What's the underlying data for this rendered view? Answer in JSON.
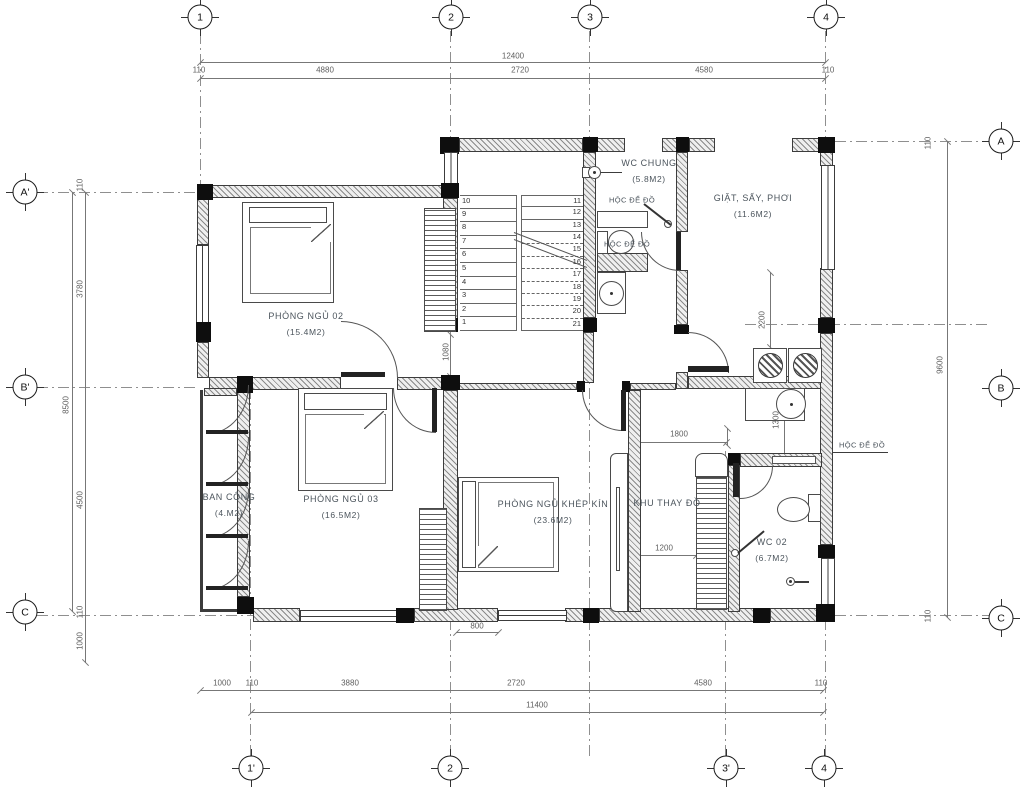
{
  "plan_title": "Second floor plan",
  "rooms": [
    {
      "id": "bedroom2",
      "name": "PHÒNG NGỦ 02",
      "area": "(15.4M2)",
      "x": 306,
      "y": 316
    },
    {
      "id": "wc-chung",
      "name": "WC CHUNG",
      "area": "(5.8M2)",
      "x": 649,
      "y": 163
    },
    {
      "id": "laundry",
      "name": "GIẶT, SẤY, PHƠI",
      "area": "(11.6M2)",
      "x": 753,
      "y": 198
    },
    {
      "id": "bedroom3",
      "name": "PHÒNG NGỦ 03",
      "area": "(16.5M2)",
      "x": 341,
      "y": 499
    },
    {
      "id": "master-bedroom",
      "name": "PHÒNG NGỦ KHÉP KÍN",
      "area": "(23.6M2)",
      "x": 553,
      "y": 504
    },
    {
      "id": "balcony",
      "name": "BAN CÔNG",
      "area": "(4.M2)",
      "x": 229,
      "y": 497
    },
    {
      "id": "dressing",
      "name": "KHU THAY ĐỒ",
      "area": "",
      "x": 667,
      "y": 503
    },
    {
      "id": "wc02",
      "name": "WC 02",
      "area": "(6.7M2)",
      "x": 772,
      "y": 542
    }
  ],
  "storage_labels": [
    {
      "text": "HỘC ĐỂ ĐỒ",
      "x": 632,
      "y": 200
    },
    {
      "text": "HỘC ĐỂ ĐỒ",
      "x": 627,
      "y": 244
    },
    {
      "text": "HỘC ĐỂ ĐỒ",
      "x": 862,
      "y": 445
    }
  ],
  "grid_bubbles": [
    {
      "label": "1",
      "x": 200,
      "y": 17
    },
    {
      "label": "2",
      "x": 451,
      "y": 17
    },
    {
      "label": "3",
      "x": 590,
      "y": 17
    },
    {
      "label": "4",
      "x": 826,
      "y": 17
    },
    {
      "label": "1'",
      "x": 251,
      "y": 768
    },
    {
      "label": "2",
      "x": 450,
      "y": 768
    },
    {
      "label": "3'",
      "x": 726,
      "y": 768
    },
    {
      "label": "4",
      "x": 824,
      "y": 768
    },
    {
      "label": "A'",
      "x": 25,
      "y": 192
    },
    {
      "label": "B'",
      "x": 25,
      "y": 387
    },
    {
      "label": "C",
      "x": 25,
      "y": 612
    },
    {
      "label": "A",
      "x": 1001,
      "y": 141
    },
    {
      "label": "B",
      "x": 1001,
      "y": 388
    },
    {
      "label": "C",
      "x": 1001,
      "y": 618
    }
  ],
  "dimensions": [
    {
      "text": "12400",
      "x": 513,
      "y": 56,
      "rot": false
    },
    {
      "text": "110",
      "x": 199,
      "y": 70,
      "rot": false
    },
    {
      "text": "4880",
      "x": 325,
      "y": 70,
      "rot": false
    },
    {
      "text": "2720",
      "x": 520,
      "y": 70,
      "rot": false
    },
    {
      "text": "4580",
      "x": 704,
      "y": 70,
      "rot": false
    },
    {
      "text": "110",
      "x": 828,
      "y": 70,
      "rot": false
    },
    {
      "text": "1000",
      "x": 222,
      "y": 683,
      "rot": false
    },
    {
      "text": "110",
      "x": 252,
      "y": 683,
      "rot": false
    },
    {
      "text": "3880",
      "x": 350,
      "y": 683,
      "rot": false
    },
    {
      "text": "2720",
      "x": 516,
      "y": 683,
      "rot": false
    },
    {
      "text": "4580",
      "x": 703,
      "y": 683,
      "rot": false
    },
    {
      "text": "110",
      "x": 821,
      "y": 683,
      "rot": false
    },
    {
      "text": "11400",
      "x": 537,
      "y": 705,
      "rot": false
    },
    {
      "text": "8500",
      "x": 66,
      "y": 405,
      "rot": true
    },
    {
      "text": "110",
      "x": 80,
      "y": 185,
      "rot": true
    },
    {
      "text": "3780",
      "x": 80,
      "y": 289,
      "rot": true
    },
    {
      "text": "4500",
      "x": 80,
      "y": 500,
      "rot": true
    },
    {
      "text": "110",
      "x": 80,
      "y": 612,
      "rot": true
    },
    {
      "text": "1000",
      "x": 80,
      "y": 641,
      "rot": true
    },
    {
      "text": "9600",
      "x": 940,
      "y": 365,
      "rot": true
    },
    {
      "text": "110",
      "x": 928,
      "y": 143,
      "rot": true
    },
    {
      "text": "110",
      "x": 928,
      "y": 616,
      "rot": true
    },
    {
      "text": "1800",
      "x": 679,
      "y": 434,
      "rot": false
    },
    {
      "text": "1200",
      "x": 664,
      "y": 548,
      "rot": false
    },
    {
      "text": "800",
      "x": 477,
      "y": 626,
      "rot": false
    },
    {
      "text": "1080",
      "x": 446,
      "y": 352,
      "rot": true
    },
    {
      "text": "2200",
      "x": 762,
      "y": 320,
      "rot": true
    },
    {
      "text": "1300",
      "x": 776,
      "y": 420,
      "rot": true
    }
  ],
  "stairs": {
    "left_flight": [
      "10",
      "9",
      "8",
      "7",
      "6",
      "5",
      "4",
      "3",
      "2",
      "1"
    ],
    "right_flight": [
      "11",
      "12",
      "13",
      "14",
      "15",
      "16",
      "17",
      "18",
      "19",
      "20",
      "21"
    ]
  },
  "colors": {
    "wall_line": "#3c3c3c",
    "dim": "#777777",
    "label": "#4b545c",
    "grid": "#8f8f8f"
  }
}
